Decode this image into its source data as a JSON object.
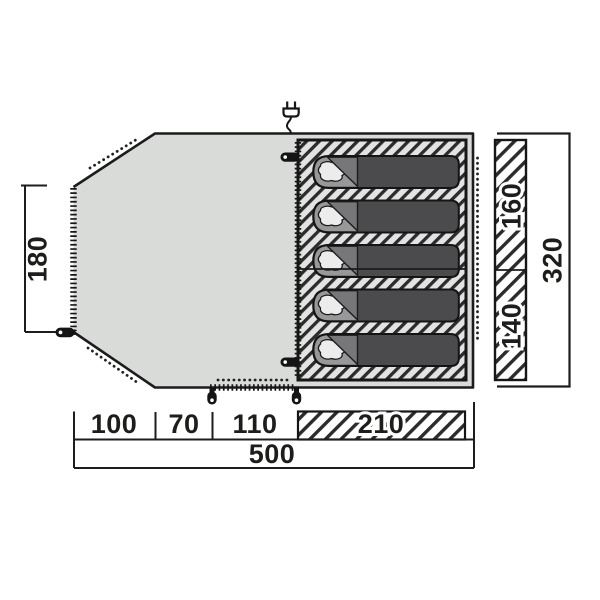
{
  "diagram": {
    "kind": "tent floorplan (top view) with dimensions",
    "unit": "cm (implied)",
    "sleeping_bags_count": 5,
    "colors": {
      "floor_fill": "#d9dbd9",
      "hatch_stroke": "#2b2b2b",
      "hatch_bg_inner": "#e3e3e3",
      "hatch_bg_dim": "#ffffff",
      "bag_fill": "#4b4b4d",
      "bag_head_fill": "#98989a",
      "bag_flap_fill": "#77777a",
      "pillow_fill": "#ececec",
      "outline": "#1c1c1c",
      "background": "#ffffff"
    },
    "icons": [
      "power-plug-icon",
      "zipper-pull-icon",
      "tent-peg-icon",
      "zipper-teeth-line",
      "dotted-guide-line"
    ]
  },
  "dimensions": {
    "porch_left_height": "180",
    "bedroom_top_depth": "160",
    "bedroom_bottom_depth": "140",
    "total_depth": "320",
    "bottom_seg_1": "100",
    "bottom_seg_2": "70",
    "bottom_seg_3": "110",
    "bedroom_width": "210",
    "total_width": "500"
  }
}
